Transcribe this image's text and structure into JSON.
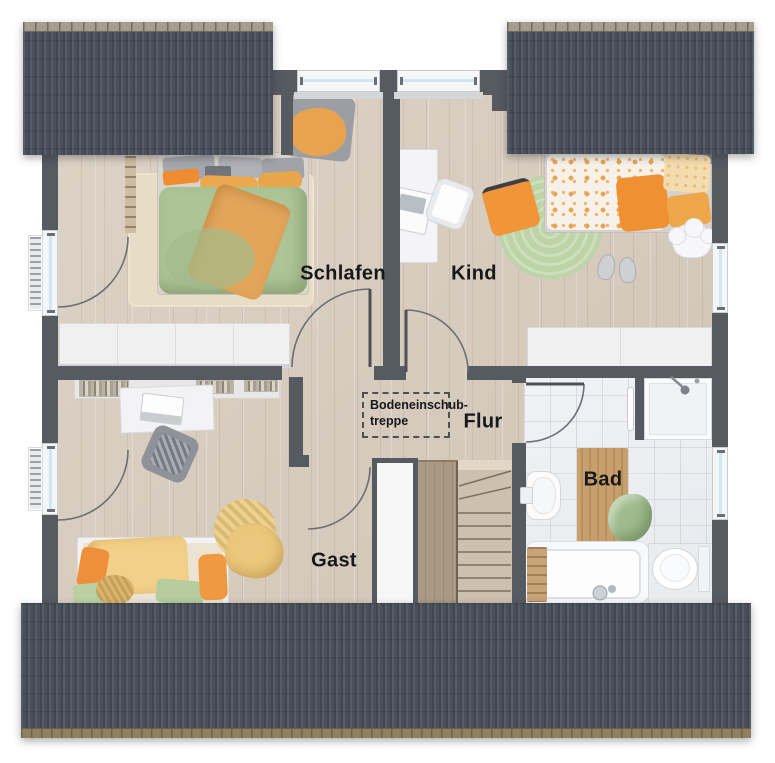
{
  "rooms": {
    "schlafen": "Schlafen",
    "kind": "Kind",
    "flur": "Flur",
    "gast": "Gast",
    "bad": "Bad"
  },
  "attic_hatch": {
    "line1": "Bodeneinschub-",
    "line2": "treppe"
  },
  "colors": {
    "roof": "#4a505a",
    "roof_ridge": "#a69d8e",
    "roof_eave": "#91805f",
    "wall": "#565b62",
    "wood_floor": "#d6cbbd",
    "tile_floor": "#edeff2",
    "duvet_green": "#adc495",
    "accent_orange": "#ee9a41",
    "rug_green": "#bcd4a6",
    "window_glass": "#cfe7f2"
  }
}
